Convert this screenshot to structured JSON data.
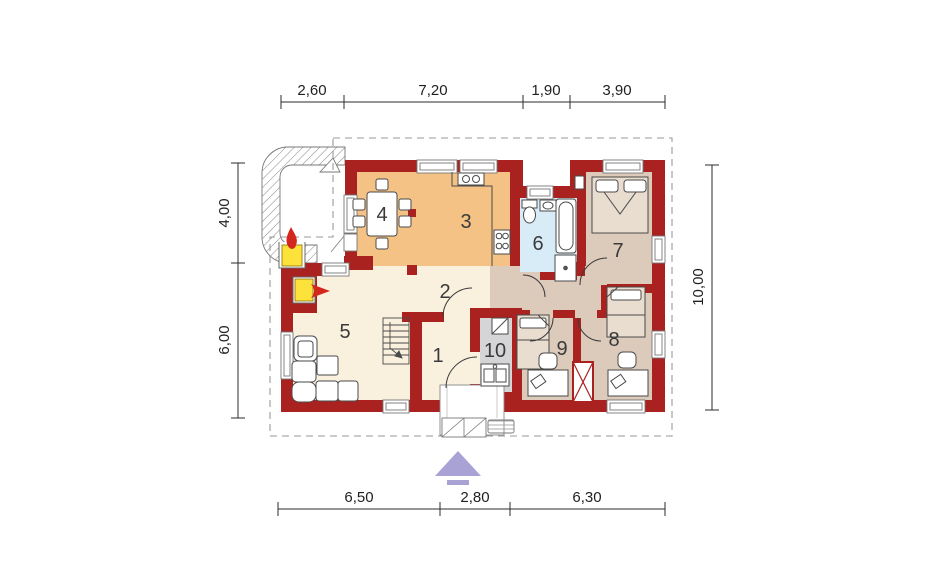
{
  "floor_plan": {
    "rooms": [
      {
        "number": "1"
      },
      {
        "number": "2"
      },
      {
        "number": "3"
      },
      {
        "number": "4"
      },
      {
        "number": "5"
      },
      {
        "number": "6"
      },
      {
        "number": "7"
      },
      {
        "number": "8"
      },
      {
        "number": "9"
      },
      {
        "number": "10"
      }
    ],
    "dimensions_m": {
      "top": [
        "2,60",
        "7,20",
        "1,90",
        "3,90"
      ],
      "bottom": [
        "6,50",
        "2,80",
        "6,30"
      ],
      "left": [
        "4,00",
        "6,00"
      ],
      "right": [
        "10,00"
      ]
    },
    "colors": {
      "wall": "#a9221f",
      "kitchen_dining": "#f5c286",
      "living_hall": "#f9f0dd",
      "night_zone": "#dccabb",
      "bathroom": "#d8ecf7",
      "wc": "#d5d5d7",
      "flame": "#d3261c",
      "firebox": "#fde23b",
      "north_arrow": "#a9a2d4"
    },
    "icons": {
      "north_arrow": "entrance-direction-arrow",
      "fireplace": "flame",
      "terrace_grill": "flame"
    }
  }
}
